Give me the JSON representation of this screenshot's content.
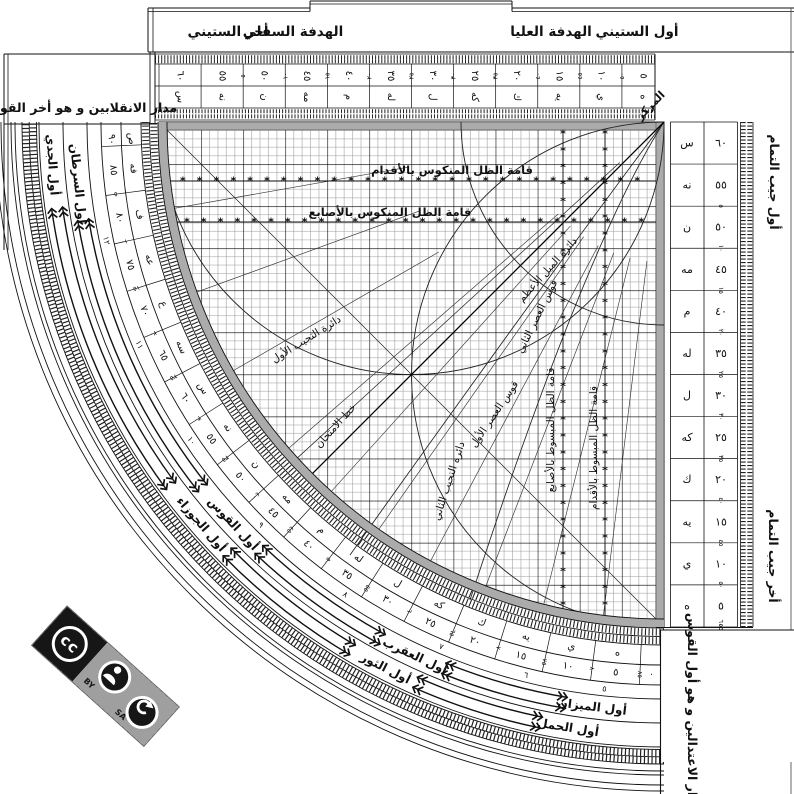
{
  "top_bar": {
    "first_sixty": "أول الستيني",
    "upper_sight": "الهدفة العليا",
    "lower_sight": "الهدفة السفلي",
    "last_sixty": "أخر الستيني"
  },
  "center_label": "المركز",
  "left_note": "مدار الانقلابين و هو أخر القوس",
  "bottom_right_note": "مدار الاعتدالين و هو أول القوس",
  "top_scale": {
    "values": [
      "٦٠",
      "٥٥",
      "٥٠",
      "٤٥",
      "٤٠",
      "٣٥",
      "٣٠",
      "٢٥",
      "٢٠",
      "١٥",
      "١٠",
      "٥"
    ],
    "abjad": [
      "س",
      "نه",
      "ن",
      "مه",
      "م",
      "له",
      "ل",
      "كه",
      "ك",
      "يه",
      "ي",
      "ه"
    ],
    "complements": [
      "٥",
      "١٠",
      "١٥",
      "٢٠",
      "٢٥",
      "٣٠",
      "٣٥",
      "٤٠",
      "٤٥",
      "٥٠",
      "٥٥",
      "٦٠"
    ]
  },
  "right_scale": {
    "top_title": "أول جيب التمام",
    "bottom_title": "أخر جيب التمام",
    "rows": [
      [
        "س",
        "٦٠"
      ],
      [
        "نه",
        "٥٥"
      ],
      [
        "ن",
        "٥٠"
      ],
      [
        "مه",
        "٤٥"
      ],
      [
        "م",
        "٤٠"
      ],
      [
        "له",
        "٣٥"
      ],
      [
        "ل",
        "٣٠"
      ],
      [
        "كه",
        "٢٥"
      ],
      [
        "ك",
        "٢٠"
      ],
      [
        "يه",
        "١٥"
      ],
      [
        "ي",
        "١٠"
      ],
      [
        "ه",
        "٥"
      ]
    ],
    "complements": [
      "٥",
      "١٠",
      "١٥",
      "٢٠",
      "٢٥",
      "٣٠",
      "٣٥",
      "٤٠",
      "٤٥",
      "٥٠",
      "٥٥",
      "٦٠"
    ]
  },
  "arc_scale": {
    "values": [
      "٩٠",
      "٨٥",
      "٨٠",
      "٧٥",
      "٧٠",
      "٦٥",
      "٦٠",
      "٥٥",
      "٥٠",
      "٤٥",
      "٤٠",
      "٣٥",
      "٣٠",
      "٢٥",
      "٢٠",
      "١٥",
      "١٠",
      "٥"
    ],
    "abjad": [
      "ص",
      "فه",
      "ف",
      "عه",
      "ع",
      "سه",
      "س",
      "نه",
      "ن",
      "مه",
      "م",
      "له",
      "ل",
      "كه",
      "ك",
      "يه",
      "ي",
      "ه"
    ],
    "complements": [
      "٥",
      "١٠",
      "١٥",
      "٢٠",
      "٢٥",
      "٣٠",
      "٣٥",
      "٤٠",
      "٤٥",
      "٥٠",
      "٥٥",
      "٦٠",
      "٦٥",
      "٧٠",
      "٧٥",
      "٨٠",
      "٨٥"
    ],
    "end": "٠"
  },
  "hour_ring": [
    "١٢",
    "١١",
    "١٠",
    "٩",
    "٨",
    "٧",
    "٦",
    "٥"
  ],
  "zodiac": {
    "outer": [
      "أول الجدي",
      "أول الجوزاء",
      "أول الثور",
      "أول الحمل"
    ],
    "inner": [
      "أول السرطان",
      "أول القوس",
      "أول العقرب",
      "أول الميزان"
    ]
  },
  "grid_labels": {
    "inverted_feet": "قامة الظل المنكوس بالأقدام",
    "inverted_digits": "قامة الظل المنكوس بالأصابع",
    "extended_digits": "قامة الظل المبسوط بالأصابع",
    "extended_feet": "قامة الظل المبسوط بالأقدام",
    "obliquity": "دائرة الميل الأعظم",
    "asr_second": "قوس العصر الثاني",
    "asr_first": "قوس العصر الأول",
    "sine_first": "دائرة التجيب الأول",
    "sine_second": "دائرة التجيب الثاني",
    "test_line": "خط الامتحان"
  },
  "cc_badge": {
    "cc": "cc",
    "by": "BY",
    "sa": "SA"
  }
}
